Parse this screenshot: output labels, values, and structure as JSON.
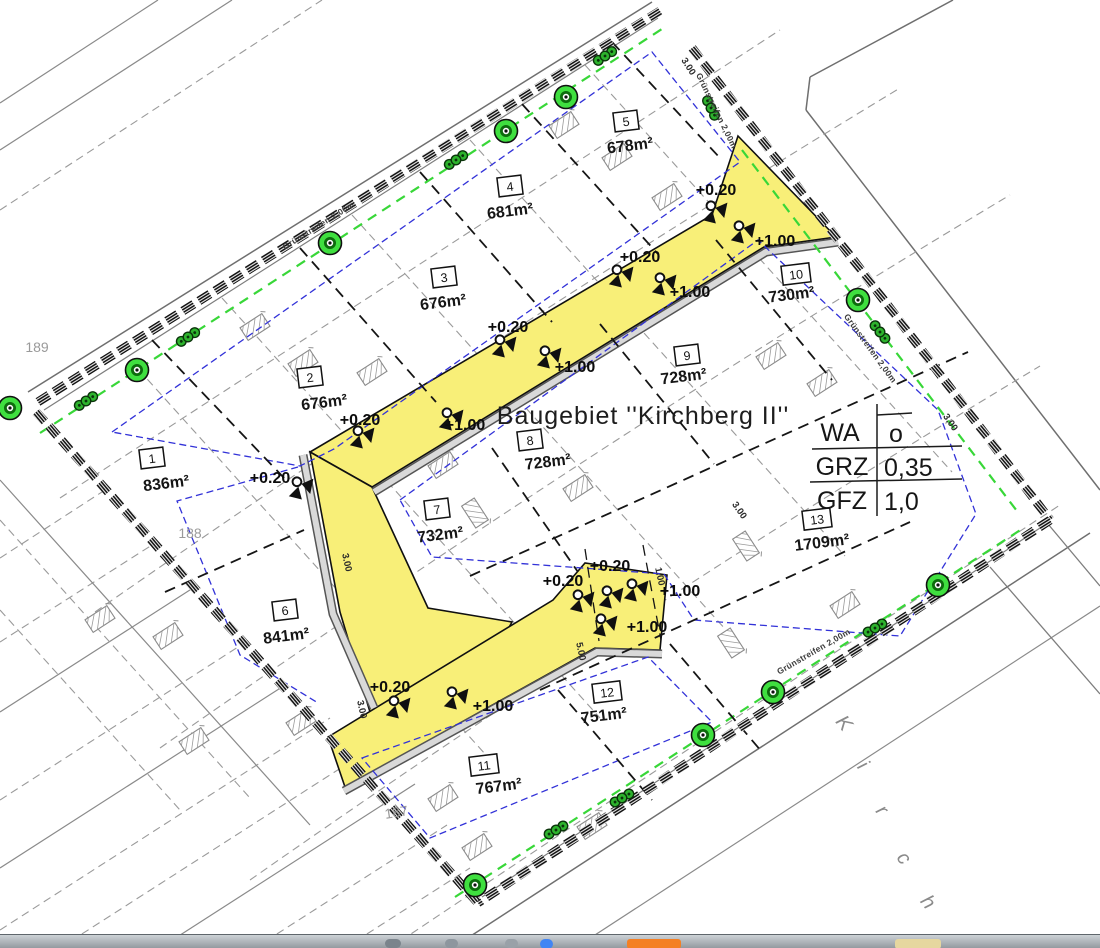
{
  "plan": {
    "title": "Baugebiet ''Kirchberg II''",
    "zoning_table": {
      "rows": [
        {
          "label": "WA",
          "value": "o"
        },
        {
          "label": "GRZ",
          "value": "0,35"
        },
        {
          "label": "GFZ",
          "value": "1,0"
        }
      ]
    },
    "parcels": [
      {
        "no": "1",
        "area": "836m²"
      },
      {
        "no": "2",
        "area": "676m²"
      },
      {
        "no": "3",
        "area": "676m²"
      },
      {
        "no": "4",
        "area": "681m²"
      },
      {
        "no": "5",
        "area": "678m²"
      },
      {
        "no": "6",
        "area": "841m²"
      },
      {
        "no": "7",
        "area": "732m²"
      },
      {
        "no": "8",
        "area": "728m²"
      },
      {
        "no": "9",
        "area": "728m²"
      },
      {
        "no": "10",
        "area": "730m²"
      },
      {
        "no": "11",
        "area": "767m²"
      },
      {
        "no": "12",
        "area": "751m²"
      },
      {
        "no": "13",
        "area": "1709m²"
      }
    ],
    "district_parcels": [
      {
        "text": "189"
      },
      {
        "text": "188"
      },
      {
        "text": "187"
      }
    ],
    "green_strip_label": "Grünstreifen 2,00m",
    "street_name_fragment": {
      "letters": [
        {
          "t": "K"
        },
        {
          "t": "i"
        },
        {
          "t": "r"
        },
        {
          "t": "c"
        },
        {
          "t": "h"
        }
      ]
    },
    "elevation_marks": [
      {
        "t": "+0.20"
      },
      {
        "t": "+1.00"
      },
      {
        "t": "+0.20"
      },
      {
        "t": "+1.00"
      },
      {
        "t": "+0.20"
      },
      {
        "t": "+1.00"
      },
      {
        "t": "+0.20"
      },
      {
        "t": "+1.00"
      },
      {
        "t": "+0.20"
      },
      {
        "t": "+0.20"
      },
      {
        "t": "+0.20"
      },
      {
        "t": "+1.00"
      },
      {
        "t": "+1.00"
      },
      {
        "t": "+0.20"
      },
      {
        "t": "+1.00"
      }
    ],
    "dimension_marks": [
      {
        "t": "3.00"
      },
      {
        "t": "3.00"
      },
      {
        "t": "3.00"
      },
      {
        "t": "3.00"
      },
      {
        "t": "3.00"
      },
      {
        "t": "5.00"
      },
      {
        "t": "1.00"
      }
    ],
    "colors": {
      "road_yellow": "#f8ef78",
      "greenery": "#38d738",
      "building_limit_blue": "#3232d8",
      "boundary_black": "#141414"
    }
  }
}
